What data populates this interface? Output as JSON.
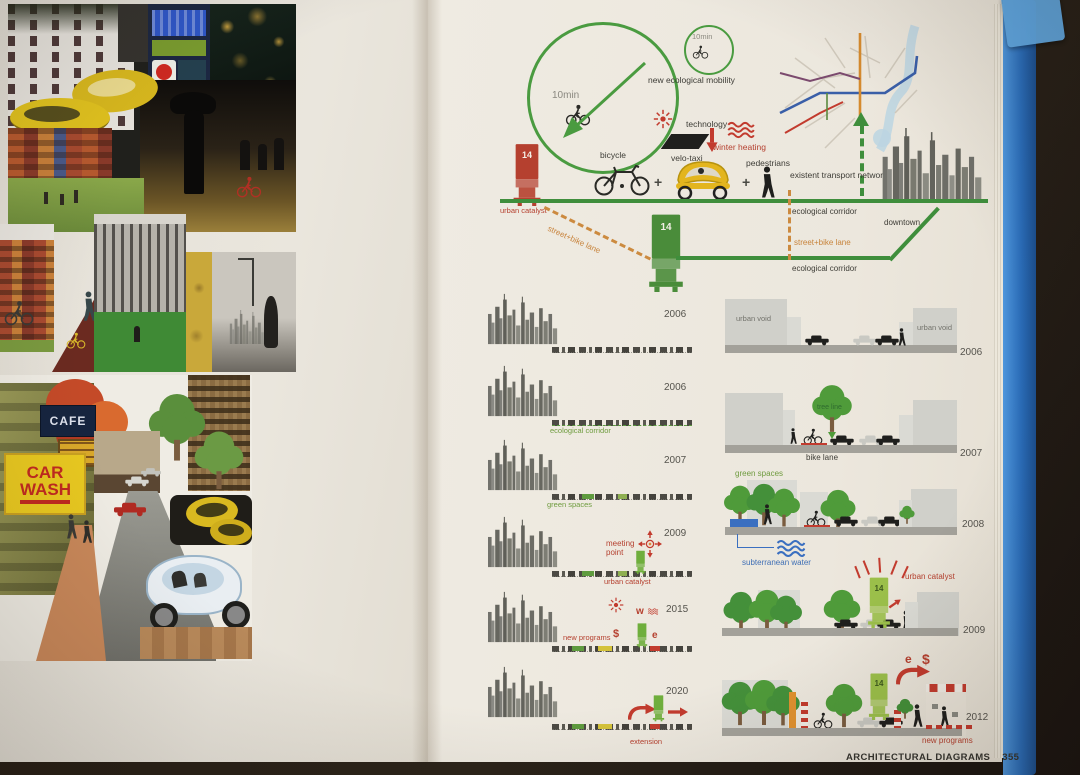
{
  "book": {
    "footer_title": "ARCHITECTURAL DIAGRAMS",
    "footer_page": "355"
  },
  "left_page": {
    "cafe_sign": "CAFE",
    "car_wash_sign": "CAR WASH"
  },
  "header": {
    "time_large": "10min",
    "time_small": "10min",
    "new_mobility": "new ecological mobility",
    "technology": "technology",
    "winter_heating": "winter heating",
    "bicycle": "bicycle",
    "velo_taxi": "velo-taxi",
    "pedestrians": "pedestrians",
    "plus_1": "+",
    "plus_2": "+",
    "urban_catalyst": "urban catalyst",
    "existent_network": "existent transport network",
    "downtown": "downtown",
    "eco_corridor_top": "ecological corridor",
    "eco_corridor_bottom": "ecological corridor",
    "street_bike_diagonal": "street+bike lane",
    "street_bike_vertical": "street+bike lane",
    "tower_red_number": "14",
    "tower_green_number": "14"
  },
  "timeline": {
    "rows": [
      {
        "year": "2006"
      },
      {
        "year": "2006",
        "label": "ecological corridor"
      },
      {
        "year": "2007",
        "label": "green spaces"
      },
      {
        "year": "2009",
        "meeting_point": "meeting point",
        "urban_catalyst": "urban catalyst"
      },
      {
        "year": "2015",
        "label": "new programs",
        "sym_dollar": "$",
        "sym_w": "w",
        "sym_e": "e"
      },
      {
        "year": "2020",
        "label": "extension"
      }
    ]
  },
  "sections": {
    "rows": [
      {
        "year": "2006",
        "urban_void_left": "urban void",
        "urban_void_right": "urban void"
      },
      {
        "year": "2007",
        "tree_line": "tree line",
        "bike_lane": "bike lane"
      },
      {
        "year": "2008",
        "green_spaces": "green spaces",
        "subterranean_water": "subterranean water"
      },
      {
        "year": "2009",
        "urban_catalyst": "urban catalyst",
        "tower_number": "14"
      },
      {
        "year": "2012",
        "new_programs": "new programs",
        "sym_e": "e",
        "sym_dollar": "$",
        "tower_number": "14"
      }
    ]
  }
}
